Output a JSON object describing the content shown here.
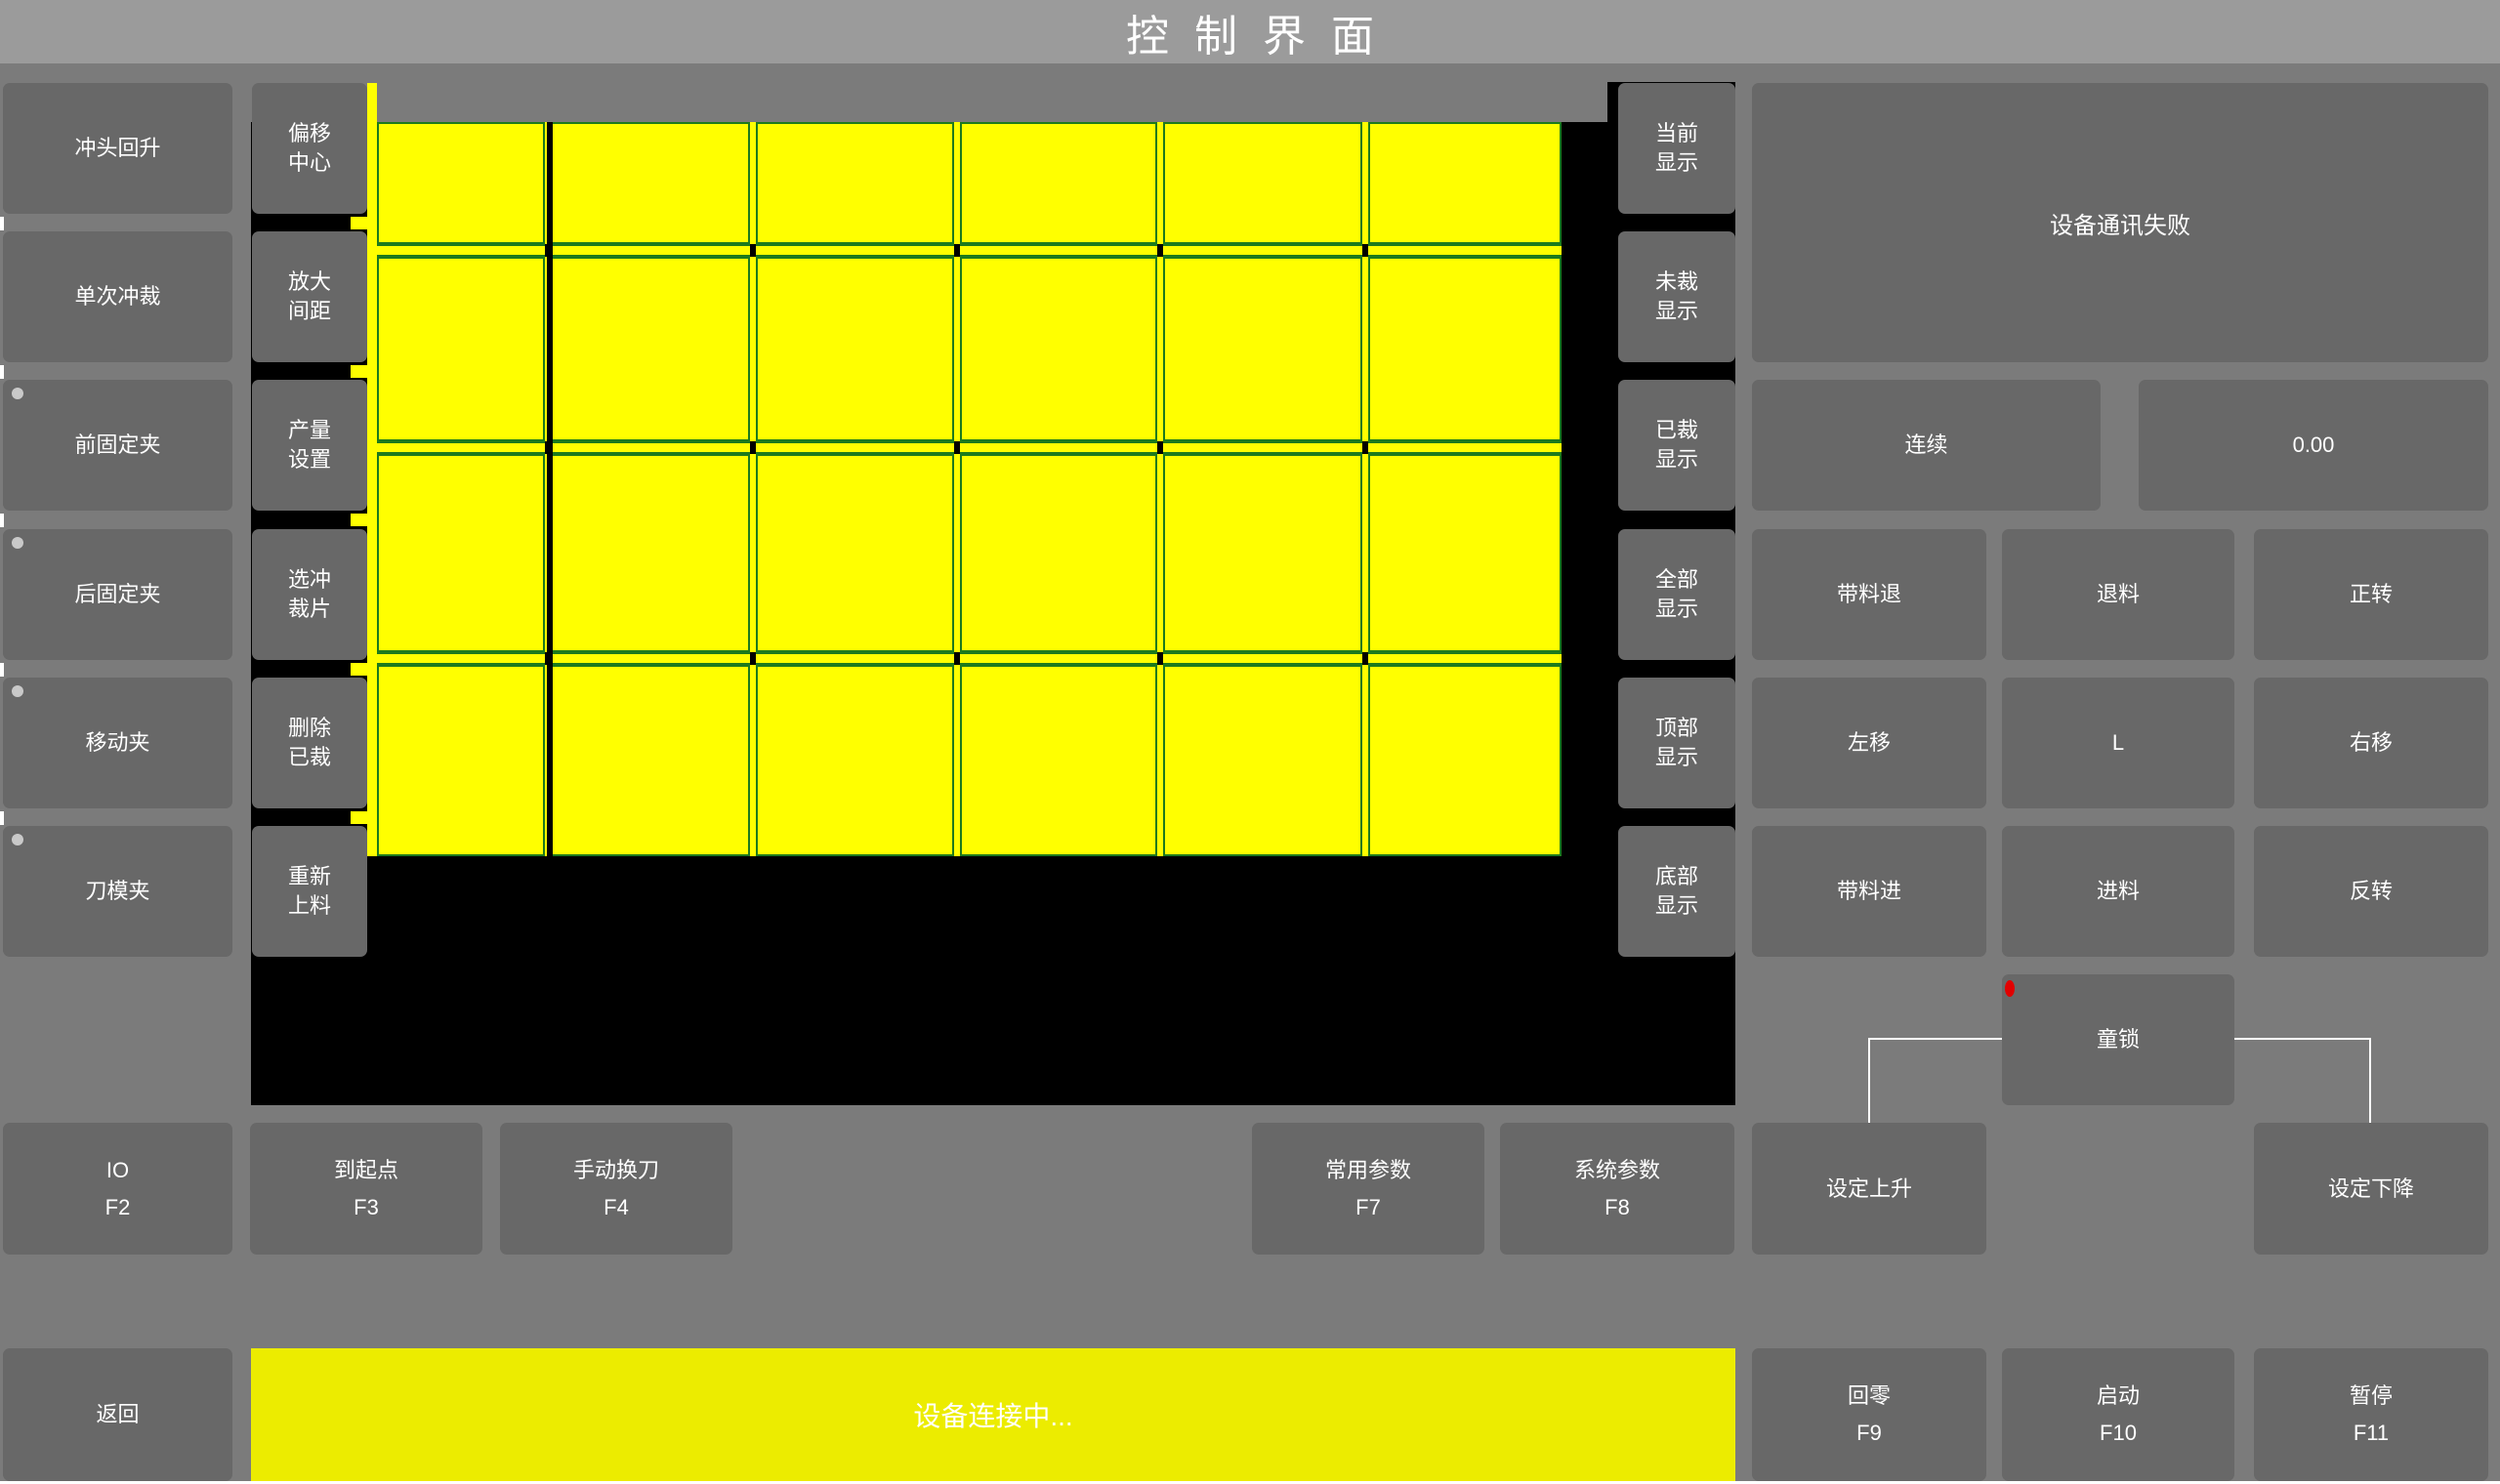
{
  "title_bar": {
    "title": "控制界面"
  },
  "left_buttons": [
    {
      "label": "冲头回升",
      "has_indicator": false
    },
    {
      "label": "单次冲裁",
      "has_indicator": false
    },
    {
      "label": "前固定夹",
      "has_indicator": true
    },
    {
      "label": "后固定夹",
      "has_indicator": true
    },
    {
      "label": "移动夹",
      "has_indicator": true
    },
    {
      "label": "刀模夹",
      "has_indicator": true
    }
  ],
  "tool_buttons": [
    {
      "line1": "偏移",
      "line2": "中心"
    },
    {
      "line1": "放大",
      "line2": "间距"
    },
    {
      "line1": "产量",
      "line2": "设置"
    },
    {
      "line1": "选冲",
      "line2": "裁片"
    },
    {
      "line1": "删除",
      "line2": "已裁"
    },
    {
      "line1": "重新",
      "line2": "上料"
    }
  ],
  "view_buttons": [
    {
      "line1": "当前",
      "line2": "显示"
    },
    {
      "line1": "未裁",
      "line2": "显示"
    },
    {
      "line1": "已裁",
      "line2": "显示"
    },
    {
      "line1": "全部",
      "line2": "显示"
    },
    {
      "line1": "顶部",
      "line2": "显示"
    },
    {
      "line1": "底部",
      "line2": "显示"
    }
  ],
  "grid": {
    "rows": 4,
    "columns": 6
  },
  "right_panel": {
    "message": "设备通讯失败",
    "mode_button": "连续",
    "value_display": "0.00",
    "jog_rows": [
      [
        "带料退",
        "退料",
        "正转"
      ],
      [
        "左移",
        "L",
        "右移"
      ],
      [
        "带料进",
        "进料",
        "反转"
      ]
    ],
    "child_lock": "童锁"
  },
  "function_row": [
    {
      "label": "IO",
      "key": "F2"
    },
    {
      "label": "到起点",
      "key": "F3"
    },
    {
      "label": "手动换刀",
      "key": "F4"
    },
    {
      "label": "常用参数",
      "key": "F7"
    },
    {
      "label": "系统参数",
      "key": "F8"
    },
    {
      "label": "设定上升",
      "key": ""
    },
    {
      "label": "设定下降",
      "key": ""
    }
  ],
  "bottom_bar": {
    "back": "返回",
    "status": "设备连接中...",
    "zero": {
      "label": "回零",
      "key": "F9"
    },
    "start": {
      "label": "启动",
      "key": "F10"
    },
    "pause": {
      "label": "暂停",
      "key": "F11"
    }
  },
  "colors": {
    "piece_yellow": "#ffff00",
    "status_yellow": "#ecec00",
    "cut_border_green": "#1d7a1d",
    "alert_red": "#e10000",
    "titlebar_gray": "#9b9b9b",
    "button_gray": "#686868",
    "background_gray": "#7b7b7b"
  }
}
